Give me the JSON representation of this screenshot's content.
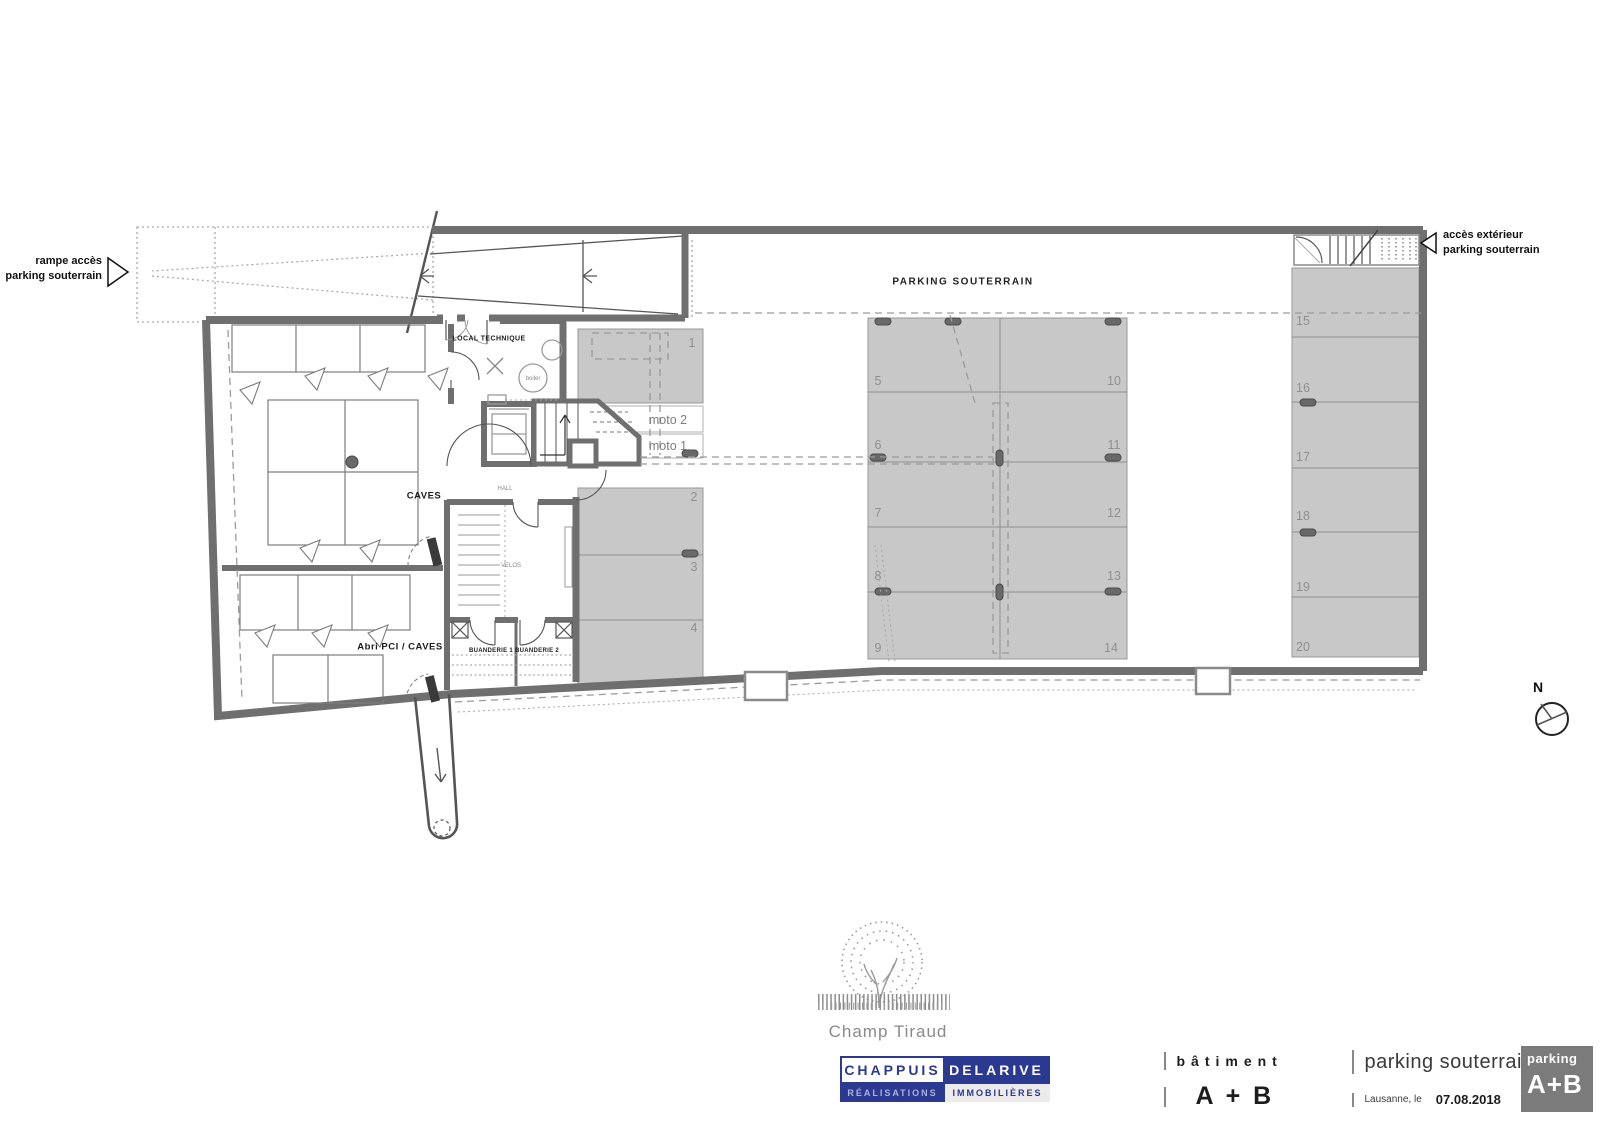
{
  "colors": {
    "wall": "#6f6f6f",
    "spot_fill": "#c8c8c8",
    "spot_line": "#979797",
    "dash": "#9b9b9b",
    "number_gray": "#8f8f8f",
    "navy": "#2b3990",
    "stamp_gray": "#7b7b7b",
    "logo_gray": "#8a8a8a"
  },
  "plan": {
    "area_title": "PARKING SOUTERRAIN",
    "ramp_label_line1": "rampe accès",
    "ramp_label_line2": "parking souterrain",
    "exterior_access_line1": "accès extérieur",
    "exterior_access_line2": "parking souterrain",
    "rooms": {
      "local_technique": "LOCAL TECHNIQUE",
      "boiler": "boiler",
      "caves": "CAVES",
      "hall": "HALL",
      "velos": "VELOS",
      "buanderie1": "BUANDERIE 1",
      "buanderie2": "BUANDERIE 2",
      "abri": "Abri PCI / CAVES"
    },
    "moto2": "moto 2",
    "moto1": "moto 1",
    "spots": [
      "1",
      "2",
      "3",
      "4",
      "5",
      "6",
      "7",
      "8",
      "9",
      "10",
      "11",
      "12",
      "13",
      "14",
      "15",
      "16",
      "17",
      "18",
      "19",
      "20"
    ],
    "north": "N"
  },
  "title_block": {
    "project_name": "Champ Tiraud",
    "company": {
      "top_left": "CHAPPUIS",
      "top_right": "DELARIVE",
      "bottom_left": "RÉALISATIONS",
      "bottom_right": "IMMOBILIÈRES"
    },
    "building_label": "bâtiment",
    "building_value": "A + B",
    "plan_title": "parking souterrain",
    "city_label": "Lausanne, le",
    "date": "07.08.2018",
    "stamp_top": "parking",
    "stamp_bottom": "A+B"
  }
}
